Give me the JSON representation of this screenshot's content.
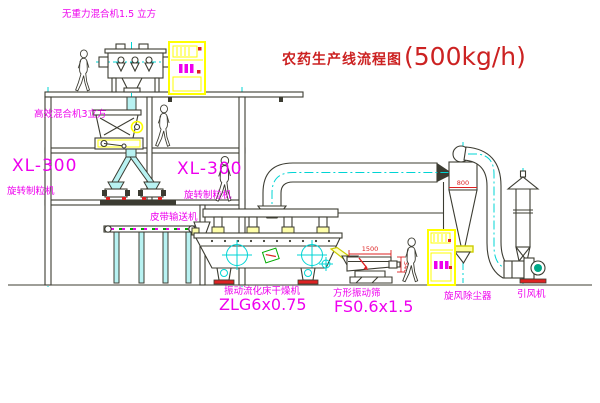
{
  "title": {
    "text": "农药生产线流程图",
    "capacity": "(500kg/h)"
  },
  "labels": {
    "top_mixer": "无重力混合机1.5 立方",
    "floor2_mixer": "高效混合机3立方",
    "granulator_left_model": "XL-300",
    "granulator_left_name": "旋转制粒机",
    "granulator_right_model": "XL-300",
    "granulator_right_name": "旋转制粒机",
    "belt_conveyor": "皮带输送机",
    "dryer_name": "振动流化床干燥机",
    "dryer_model": "ZLG6x0.75",
    "screen_name": "方形振动筛",
    "screen_model": "FS0.6x1.5",
    "cyclone_name": "旋风除尘器",
    "fan_name": "引风机"
  },
  "dimensions": {
    "cyclone": "800",
    "screen_length": "1500",
    "screen_height": "340"
  },
  "colors": {
    "label_magenta": "#ee00ee",
    "annotation_red": "#cc2222",
    "centerline_cyan": "#00d4d4",
    "line_dark": "#3c3c32",
    "cabinet_yellow": "#ffff00"
  }
}
